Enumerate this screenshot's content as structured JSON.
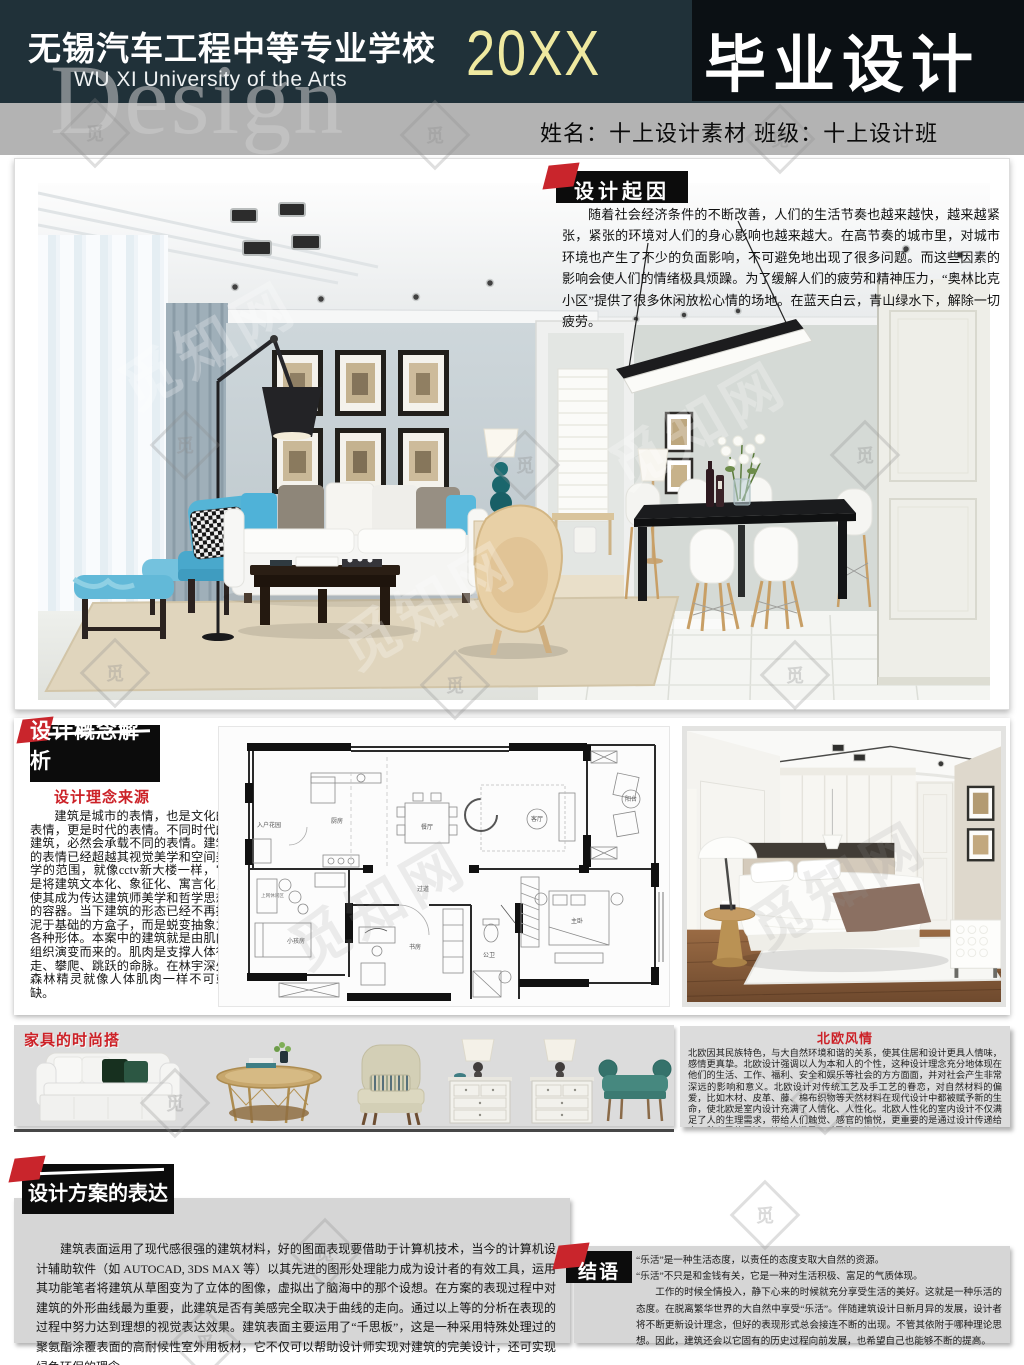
{
  "header": {
    "school_cn": "无锡汽车工程中等专业学校",
    "school_en": "WU XI University of the Arts",
    "year": "20XX",
    "title": "毕业设计"
  },
  "info_bar": {
    "text": "姓名：十上设计素材  班级：十上设计班"
  },
  "watermark": {
    "word": "Design",
    "site": "觅知网",
    "char": "觅"
  },
  "sections": {
    "origin": {
      "label": "设计起因",
      "body": "随着社会经济条件的不断改善，人们的生活节奏也越来越快，越来越紧张，紧张的环境对人们的身心影响也越来越大。在高节奏的城市里，对城市环境也产生了不少的负面影响，不可避免地出现了很多问题。而这些因素的影响会使人们的情绪极具烦躁。为了缓解人们的疲劳和精神压力，“奥林比克小区”提供了很多休闲放松心情的场地。在蓝天白云，青山绿水下，解除一切疲劳。"
    },
    "concept": {
      "label": "设计概念解析",
      "source_label": "设计理念来源",
      "body": "建筑是城市的表情，也是文化的表情，更是时代的表情。不同时代的建筑，必然会承载不同的表情。建筑的表情已经超越其视觉美学和空间美学的范围，就像cctv新大楼一样，它是将建筑文本化、象征化、寓言化，使其成为传达建筑师美学和哲学思想的容器。当下建筑的形态已经不再拘泥于基础的方盒子，而是蜕变抽象为各种形体。本案中的建筑就是由肌肉组织演变而来的。肌肉是支撑人体行走、攀爬、跳跃的命脉。在林宇深处森林精灵就像人体肌肉一样不可或缺。"
    },
    "furniture": {
      "label": "家具的时尚搭"
    },
    "nordic": {
      "title": "北欧风情",
      "body": "北欧因其民族特色，与大自然环境和谐的关系，使其住居和设计更具人情味，感情更真挚。北欧设计强调以人为本和人的个性，这种设计理念充分地体现在他们的生活、工作、福利、安全和娱乐等社会的方方面面，并对社会产生非常深远的影响和意义。北欧设计对传统工艺及手工艺的眷恋，对自然材料的偏爱，比如木材、皮革、藤、棉布织物等天然材料在现代设计中都被赋予新的生命，使北欧是室内设计充满了人情化、人性化。北欧人性化的室内设计不仅满足了人的生理需求，带给人们触觉、感官的愉悦，更重要的是通过设计传递给人一种心灵的震撼，情感的满足。对民族、传统"
    },
    "expression": {
      "label": "设计方案的表达",
      "body": "建筑表面运用了现代感很强的建筑材料，好的图面表现要借助于计算机技术，当今的计算机设计辅助软件（如 AUTOCAD, 3DS MAX 等）以其先进的图形处理能力成为设计者的有效工具，运用其功能笔者将建筑从草图变为了立体的图像，虚拟出了脑海中的那个设想。在方案的表现过程中对建筑的外形曲线最为重要，此建筑是否有美感完全取决于曲线的走向。通过以上等的分析在表现的过程中努力达到理想的视觉表达效果。建筑表面主要运用了“千思板”，这是一种采用特殊处理过的聚氨酯涂覆表面的高耐候性室外用板材，它不仅可以帮助设计师实现对建筑的完美设计，还可实现绿色环保的理念。"
    },
    "conclusion": {
      "label": "结语",
      "lines": [
        "“乐活”是一种生活态度，以责任的态度支取大自然的资源。",
        "“乐活”不只是和金钱有关，它是一种对生活积极、富足的气质体现。",
        "工作的时候全情投入，静下心来的时候就充分享受生活的美好。这就是一种乐活的态度。在脱离繁华世界的大自然中享受“乐活”。伴随建筑设计日新月异的发展，设计者将不断更新设计理念，但好的表现形式总会接连不断的出现。不管其依附于哪种理论思想。因此，建筑还会以它固有的历史过程向前发展，也希望自己也能够不断的提高。"
      ]
    }
  },
  "floorplan": {
    "labels": [
      "入户花园",
      "厨房",
      "餐厅",
      "客厅",
      "阳台",
      "过道",
      "小孩房",
      "书房",
      "公卫",
      "主卧",
      "上网休闲区"
    ]
  },
  "colors": {
    "header_bg": "#203139",
    "title_box": "#0b1014",
    "year_yellow": "#efe9a0",
    "info_bar": "#b3b3b3",
    "accent_red": "#c9252c",
    "block_gray": "#d6d6d6"
  }
}
